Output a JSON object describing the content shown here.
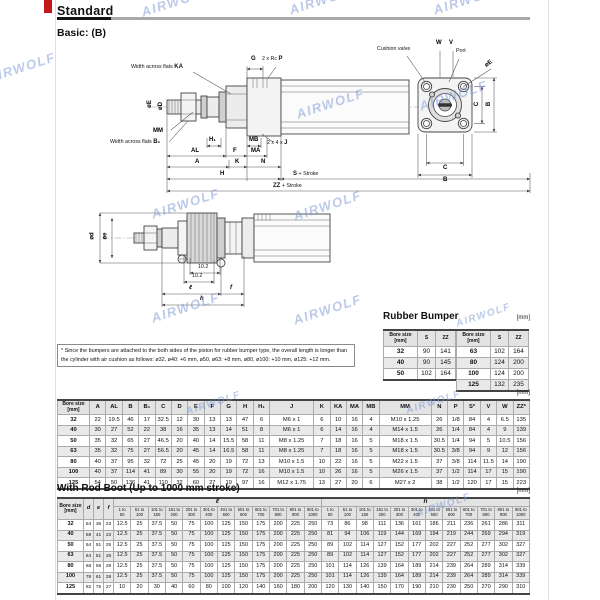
{
  "page": {
    "title": "Standard",
    "subtitle": "Basic: (B)",
    "watermark": "AIRWOLF"
  },
  "drawing_basic": {
    "labels": {
      "flats_text": "Width across flats",
      "ka": "KA",
      "g": "G",
      "rc_text": "2 x Rc",
      "p_key": "P",
      "cushion_valve": "Cushion valve",
      "w": "W",
      "v": "V",
      "port": "Port",
      "oe": "øE",
      "od": "øD",
      "mm": "MM",
      "b1": "B₁",
      "h1": "H₁",
      "mb": "MB",
      "j_text": "2 x 4 x",
      "j_key": "J",
      "al": "AL",
      "f": "F",
      "ma": "MA",
      "a": "A",
      "k": "K",
      "n": "N",
      "h": "H",
      "s_key": "S",
      "zz_key": "ZZ",
      "stroke_suffix": "+ Stroke",
      "c": "C",
      "b": "B"
    }
  },
  "drawing_boot": {
    "labels": {
      "od": "ød",
      "oe": "øe",
      "dim": "10.2",
      "l": "ℓ",
      "f": "f",
      "h": "h"
    }
  },
  "note": {
    "text": "* Since the bumpers are attached to the both sides of the piston for rubber bumper type, the overall length is longer than the cylinder with air cushion as follows: ø32, ø40: +6 mm, ø50, ø63: +8 mm, ø80, ø100: +10 mm, ø125: +12 mm."
  },
  "rubber_bumper": {
    "title": "Rubber Bumper",
    "unit": "[mm]",
    "col_bore": "Bore size",
    "col_bore_unit": "[mm]",
    "col_s": "S",
    "col_zz": "ZZ",
    "left_rows": [
      [
        "32",
        "90",
        "141"
      ],
      [
        "40",
        "90",
        "145"
      ],
      [
        "50",
        "102",
        "164"
      ]
    ],
    "right_rows": [
      [
        "63",
        "102",
        "164"
      ],
      [
        "80",
        "124",
        "200"
      ],
      [
        "100",
        "124",
        "200"
      ],
      [
        "125",
        "132",
        "235"
      ]
    ]
  },
  "dimensions_table": {
    "unit": "[mm]",
    "bore_header": "Bore size",
    "bore_unit": "[mm]",
    "columns": [
      "A",
      "AL",
      "B",
      "B₁",
      "C",
      "D",
      "E",
      "F",
      "G",
      "H",
      "H₁",
      "J",
      "K",
      "KA",
      "MA",
      "MB",
      "MM",
      "N",
      "P",
      "S*",
      "V",
      "W",
      "ZZ*"
    ],
    "rows": [
      {
        "bore": "32",
        "values": [
          "22",
          "19.5",
          "46",
          "17",
          "32.5",
          "12",
          "30",
          "13",
          "13",
          "47",
          "6",
          "M6 x 1",
          "6",
          "10",
          "16",
          "4",
          "M10 x 1.25",
          "26",
          "1/8",
          "84",
          "4",
          "6.5",
          "135"
        ]
      },
      {
        "bore": "40",
        "values": [
          "30",
          "27",
          "52",
          "22",
          "38",
          "16",
          "35",
          "13",
          "14",
          "51",
          "8",
          "M6 x 1",
          "6",
          "14",
          "16",
          "4",
          "M14 x 1.5",
          "26",
          "1/4",
          "84",
          "4",
          "9",
          "139"
        ]
      },
      {
        "bore": "50",
        "values": [
          "35",
          "32",
          "65",
          "27",
          "46.5",
          "20",
          "40",
          "14",
          "15.5",
          "58",
          "11",
          "M8 x 1.25",
          "7",
          "18",
          "16",
          "5",
          "M18 x 1.5",
          "30.5",
          "1/4",
          "94",
          "5",
          "10.5",
          "156"
        ]
      },
      {
        "bore": "63",
        "values": [
          "35",
          "32",
          "75",
          "27",
          "56.5",
          "20",
          "45",
          "14",
          "16.5",
          "58",
          "11",
          "M8 x 1.25",
          "7",
          "18",
          "16",
          "5",
          "M18 x 1.5",
          "30.5",
          "3/8",
          "94",
          "9",
          "12",
          "156"
        ]
      },
      {
        "bore": "80",
        "values": [
          "40",
          "37",
          "95",
          "32",
          "72",
          "25",
          "45",
          "20",
          "19",
          "72",
          "13",
          "M10 x 1.5",
          "10",
          "22",
          "16",
          "5",
          "M22 x 1.5",
          "37",
          "3/8",
          "114",
          "11.5",
          "14",
          "190"
        ]
      },
      {
        "bore": "100",
        "values": [
          "40",
          "37",
          "114",
          "41",
          "89",
          "30",
          "55",
          "20",
          "19",
          "72",
          "16",
          "M10 x 1.5",
          "10",
          "26",
          "16",
          "5",
          "M26 x 1.5",
          "37",
          "1/2",
          "114",
          "17",
          "15",
          "190"
        ]
      },
      {
        "bore": "125",
        "values": [
          "54",
          "50",
          "136",
          "41",
          "110",
          "32",
          "60",
          "27",
          "19",
          "97",
          "16",
          "M12 x 1.75",
          "13",
          "27",
          "20",
          "6",
          "M27 x 2",
          "38",
          "1/2",
          "120",
          "17",
          "15",
          "223"
        ]
      }
    ]
  },
  "rod_boot_table": {
    "title": "With Rod Boot (Up to 1000 mm stroke)",
    "unit": "[mm]",
    "bore_header": "Bore size",
    "bore_unit": "[mm]",
    "def_columns": [
      "d",
      "e",
      "f"
    ],
    "group_l": "ℓ",
    "group_h": "h",
    "stroke_ranges": [
      "1 to 50",
      "51 to 100",
      "101 to 150",
      "151 to 200",
      "201 to 300",
      "301 to 400",
      "401 to 500",
      "501 to 600",
      "601 to 700",
      "701 to 800",
      "801 to 900",
      "901 to 1000"
    ],
    "rows": [
      {
        "bore": "32",
        "d": "54",
        "e": "36",
        "f": "23",
        "l": [
          "12.5",
          "25",
          "37.5",
          "50",
          "75",
          "100",
          "125",
          "150",
          "175",
          "200",
          "225",
          "250"
        ],
        "h": [
          "73",
          "86",
          "98",
          "111",
          "136",
          "161",
          "186",
          "211",
          "236",
          "261",
          "286",
          "311"
        ]
      },
      {
        "bore": "40",
        "d": "58",
        "e": "41",
        "f": "23",
        "l": [
          "12.5",
          "25",
          "37.5",
          "50",
          "75",
          "100",
          "125",
          "150",
          "175",
          "200",
          "225",
          "250"
        ],
        "h": [
          "81",
          "94",
          "106",
          "119",
          "144",
          "169",
          "194",
          "219",
          "244",
          "269",
          "294",
          "319"
        ]
      },
      {
        "bore": "50",
        "d": "64",
        "e": "51",
        "f": "25",
        "l": [
          "12.5",
          "25",
          "37.5",
          "50",
          "75",
          "100",
          "125",
          "150",
          "175",
          "200",
          "225",
          "250"
        ],
        "h": [
          "89",
          "102",
          "114",
          "127",
          "152",
          "177",
          "202",
          "227",
          "252",
          "277",
          "302",
          "327"
        ]
      },
      {
        "bore": "63",
        "d": "64",
        "e": "51",
        "f": "25",
        "l": [
          "12.5",
          "25",
          "37.5",
          "50",
          "75",
          "100",
          "125",
          "150",
          "175",
          "200",
          "225",
          "250"
        ],
        "h": [
          "89",
          "102",
          "114",
          "127",
          "152",
          "177",
          "202",
          "227",
          "252",
          "277",
          "302",
          "327"
        ]
      },
      {
        "bore": "80",
        "d": "68",
        "e": "58",
        "f": "29",
        "l": [
          "12.5",
          "25",
          "37.5",
          "50",
          "75",
          "100",
          "125",
          "150",
          "175",
          "200",
          "225",
          "250"
        ],
        "h": [
          "101",
          "114",
          "126",
          "139",
          "164",
          "189",
          "214",
          "239",
          "264",
          "289",
          "314",
          "339"
        ]
      },
      {
        "bore": "100",
        "d": "78",
        "e": "61",
        "f": "29",
        "l": [
          "12.5",
          "25",
          "37.5",
          "50",
          "75",
          "100",
          "125",
          "150",
          "175",
          "200",
          "225",
          "250"
        ],
        "h": [
          "101",
          "114",
          "126",
          "139",
          "164",
          "189",
          "214",
          "239",
          "264",
          "289",
          "314",
          "339"
        ]
      },
      {
        "bore": "125",
        "d": "82",
        "e": "75",
        "f": "27",
        "l": [
          "10",
          "20",
          "30",
          "40",
          "60",
          "80",
          "100",
          "120",
          "140",
          "160",
          "180",
          "200"
        ],
        "h": [
          "120",
          "130",
          "140",
          "150",
          "170",
          "190",
          "210",
          "230",
          "250",
          "270",
          "290",
          "310"
        ]
      }
    ]
  }
}
